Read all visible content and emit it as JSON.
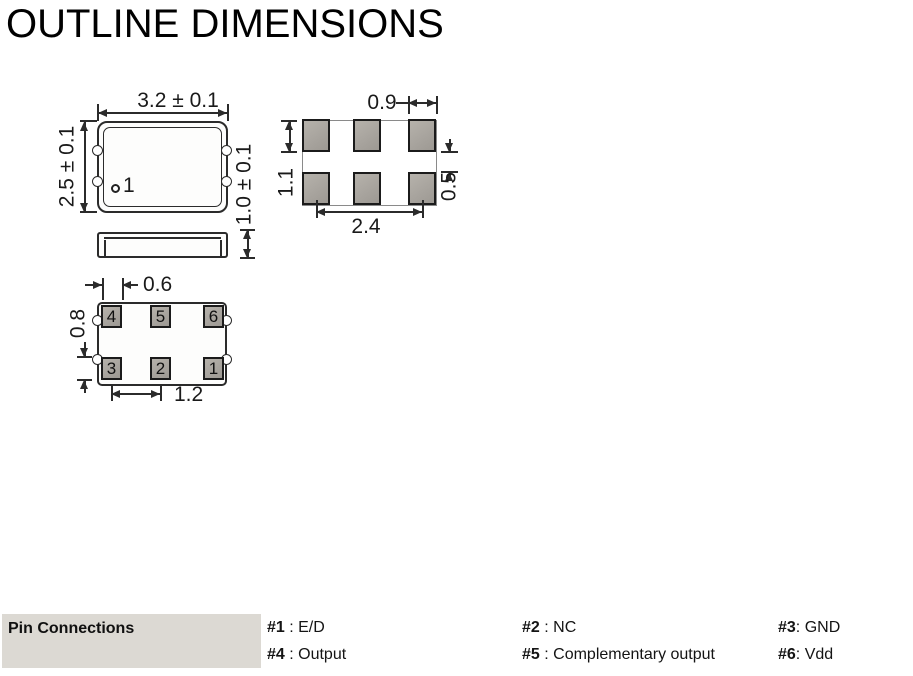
{
  "title": "OUTLINE DIMENSIONS",
  "top_view": {
    "width_dim": "3.2 ± 0.1",
    "height_dim": "2.5 ± 0.1",
    "thickness_dim": "1.0 ± 0.1",
    "pin1_label": "1"
  },
  "pad_layout": {
    "pad_width_dim": "0.9",
    "pad_height_dim": "1.1",
    "row_gap_dim": "0.5",
    "span_dim": "2.4"
  },
  "bottom_view": {
    "pad_width_dim": "0.6",
    "pad_height_dim": "0.8",
    "pitch_dim": "1.2",
    "pins": [
      "4",
      "5",
      "6",
      "3",
      "2",
      "1"
    ]
  },
  "pin_connections": {
    "label": "Pin Connections",
    "entries": [
      {
        "pin": "#1",
        "desc": " : E/D"
      },
      {
        "pin": "#2",
        "desc": " : NC"
      },
      {
        "pin": "#3",
        "desc": ": GND"
      },
      {
        "pin": "#4",
        "desc": " : Output"
      },
      {
        "pin": "#5",
        "desc": " : Complementary output"
      },
      {
        "pin": "#6",
        "desc": ": Vdd"
      }
    ]
  },
  "colors": {
    "label_cell_bg": "#dcd9d3",
    "pad_fill": "#a8a49e",
    "line": "#2b2b2b"
  }
}
